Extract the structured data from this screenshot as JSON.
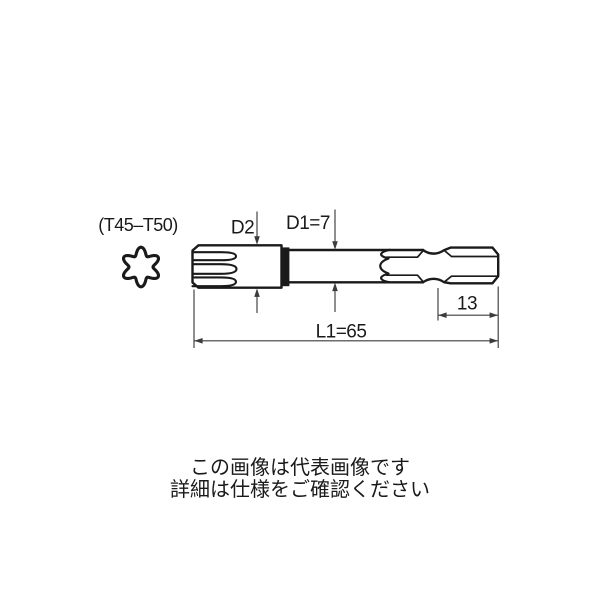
{
  "drawing": {
    "size_range_label": "(T45–T50)",
    "d2_label": "D2",
    "d1_label": "D1=7",
    "hex_length_label": "13",
    "overall_length_label": "L1=65",
    "cross_section_icon": "torx-star-cross-section"
  },
  "notes": {
    "line1": "この画像は代表画像です",
    "line2": "詳細は仕様をご確認ください"
  },
  "colors": {
    "outline": "#1a1a1a",
    "dimension": "#3c3c3c",
    "text": "#1a1a1a",
    "background": "#ffffff"
  }
}
